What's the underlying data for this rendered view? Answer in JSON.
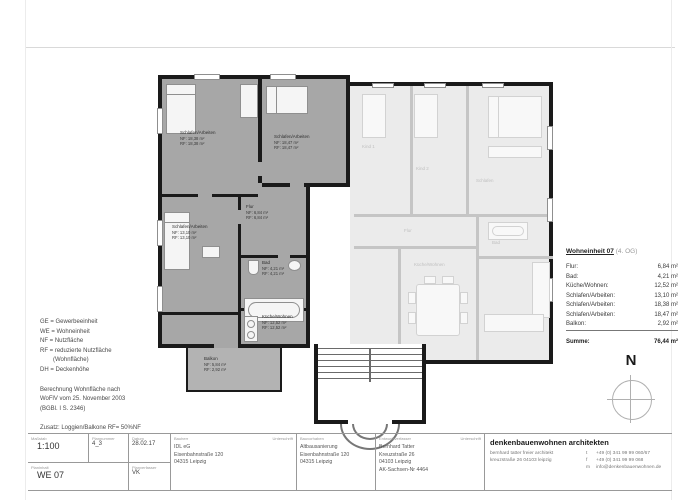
{
  "page": {
    "north_label": "N"
  },
  "colors": {
    "we07_fill": "#a7a7a7",
    "neighbor_fill": "#ebebeb",
    "wall": "#1a1a1a"
  },
  "legend": {
    "abbr": [
      "GE = Gewerbeeinheit",
      "WE = Wohneinheit",
      "NF = Nutzfläche",
      "RF = reduzierte Nutzfläche",
      "(Wohnfläche)",
      "DH = Deckenhöhe"
    ],
    "note": [
      "Berechnung Wohnfläche nach",
      "WoFlV vom 25. November 2003",
      "(BGBl. I S. 2346)"
    ],
    "addendum": "Zusatz: Loggien/Balkone RF= 50%NF"
  },
  "summary": {
    "title": "Wohneinheit 07",
    "title_suffix": "(4. OG)",
    "rows": [
      {
        "label": "Flur:",
        "value": "6,84 m²"
      },
      {
        "label": "Bad:",
        "value": "4,21 m²"
      },
      {
        "label": "Küche/Wohnen:",
        "value": "12,52 m²"
      },
      {
        "label": "Schlafen/Arbeiten:",
        "value": "13,10 m²"
      },
      {
        "label": "Schlafen/Arbeiten:",
        "value": "18,38 m²"
      },
      {
        "label": "Schlafen/Arbeiten:",
        "value": "18,47 m²"
      },
      {
        "label": "Balkon:",
        "value": "2,92 m²"
      }
    ],
    "total_label": "Summe:",
    "total_value": "76,44 m²"
  },
  "plan": {
    "we07_rooms": [
      {
        "name": "Schlafen/Arbeiten",
        "nf": "NF: 18,38 m²",
        "rf": "RF: 18,38 m²"
      },
      {
        "name": "Schlafen/Arbeiten",
        "nf": "NF: 18,47 m²",
        "rf": "RF: 18,47 m²"
      },
      {
        "name": "Schlafen/Arbeiten",
        "nf": "NF: 13,10 m²",
        "rf": "RF: 13,10 m²"
      },
      {
        "name": "Flur",
        "nf": "NF: 6,84 m²",
        "rf": "RF: 6,84 m²"
      },
      {
        "name": "Bad",
        "nf": "NF: 4,21 m²",
        "rf": "RF: 4,21 m²"
      },
      {
        "name": "Küche/Wohnen",
        "nf": "NF: 12,52 m²",
        "rf": "RF: 12,52 m²"
      },
      {
        "name": "Balkon",
        "nf": "NF: 5,84 m²",
        "rf": "RF: 2,92 m²"
      }
    ],
    "neighbor_rooms": [
      "Kind 1",
      "Kind 2",
      "Schlafen",
      "Flur",
      "Küche/Wohnen",
      "Bad"
    ]
  },
  "titleblock": {
    "masstab_label": "Maßstab",
    "masstab": "1:100",
    "plannummer_label": "Plannummer",
    "plannummer": "4_3",
    "datum_label": "Datum",
    "datum": "28.02.17",
    "planinhalt_label": "Planinhalt",
    "planinhalt": "WE 07",
    "planverfasser_label": "Planverfasser",
    "planverfasser": "VK",
    "unterschrift_label": "Unterschrift",
    "bauherr_label": "Bauherr",
    "bauherr_lines": [
      "IDL eG",
      "Eisenbahnstraße 120",
      "04315 Leipzig"
    ],
    "bauvorhaben_label": "Bauvorhaben",
    "bauvorhaben_lines": [
      "Altbausanierung",
      "Eisenbahnstraße 120",
      "04315 Leipzig"
    ],
    "entwurf_label": "Entwurfsverfasser",
    "entwurf_lines": [
      "Bernhard Tatter",
      "Kreuzstraße 26",
      "04103 Leipzig",
      "AK-Sachsen-Nr 4464"
    ],
    "firm_name": "denkenbauenwohnen architekten",
    "firm_rows": [
      {
        "left": "bernhard tatter freier architekt",
        "key": "t",
        "val": "+49 (0) 341 99 99 060/67"
      },
      {
        "left": "kreuzstraße 26  04103 leipzig",
        "key": "f",
        "val": "+49 (0) 341 99 99 068"
      },
      {
        "left": "",
        "key": "m",
        "val": "info@denkenbauenwohnen.de"
      }
    ]
  }
}
